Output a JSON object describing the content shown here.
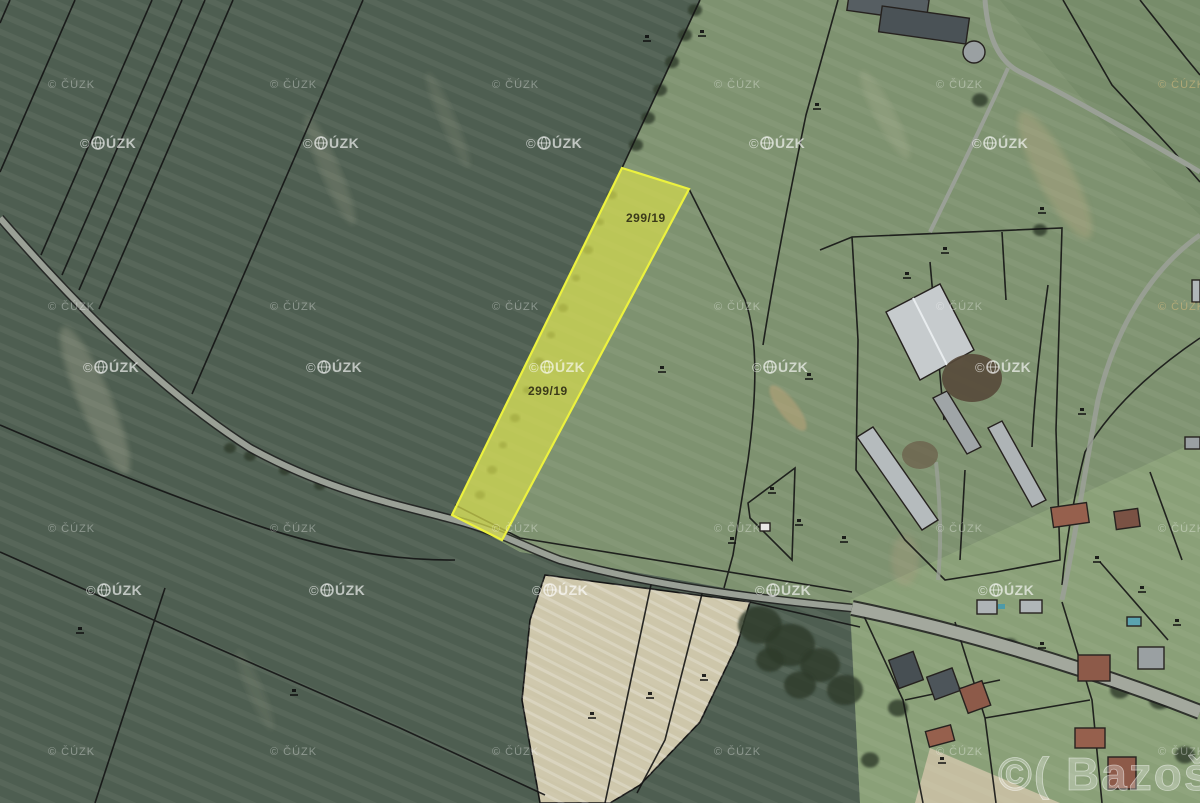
{
  "map": {
    "type": "cadastral-aerial-map",
    "highlighted_parcel": {
      "number": "299/19",
      "fill_color": "#d3da4e",
      "border_color": "#ecf23e",
      "label_color": "#3b3a1a"
    },
    "watermarks": {
      "cuzk_small": "© ČÚZK",
      "cuzk_large_prefix": "©",
      "cuzk_large_suffix": "ÚZK",
      "brand_bottom_right": "©( Bazoš.cz"
    },
    "colors": {
      "field_dark": "#4e5e51",
      "field_light": "#7e9270",
      "village_green": "#8aa078",
      "plowed_field": "#cdc6aa",
      "road": "#9aa096",
      "cadastral_line": "#151515",
      "roof_red": "#96604d",
      "roof_gray": "#aeb4b6",
      "watermark_white": "rgba(255,255,255,0.75)",
      "watermark_faint": "rgba(255,255,255,0.34)",
      "watermark_tan": "rgba(210,185,125,0.6)",
      "brand_fill": "rgba(255,255,255,0.28)"
    }
  }
}
